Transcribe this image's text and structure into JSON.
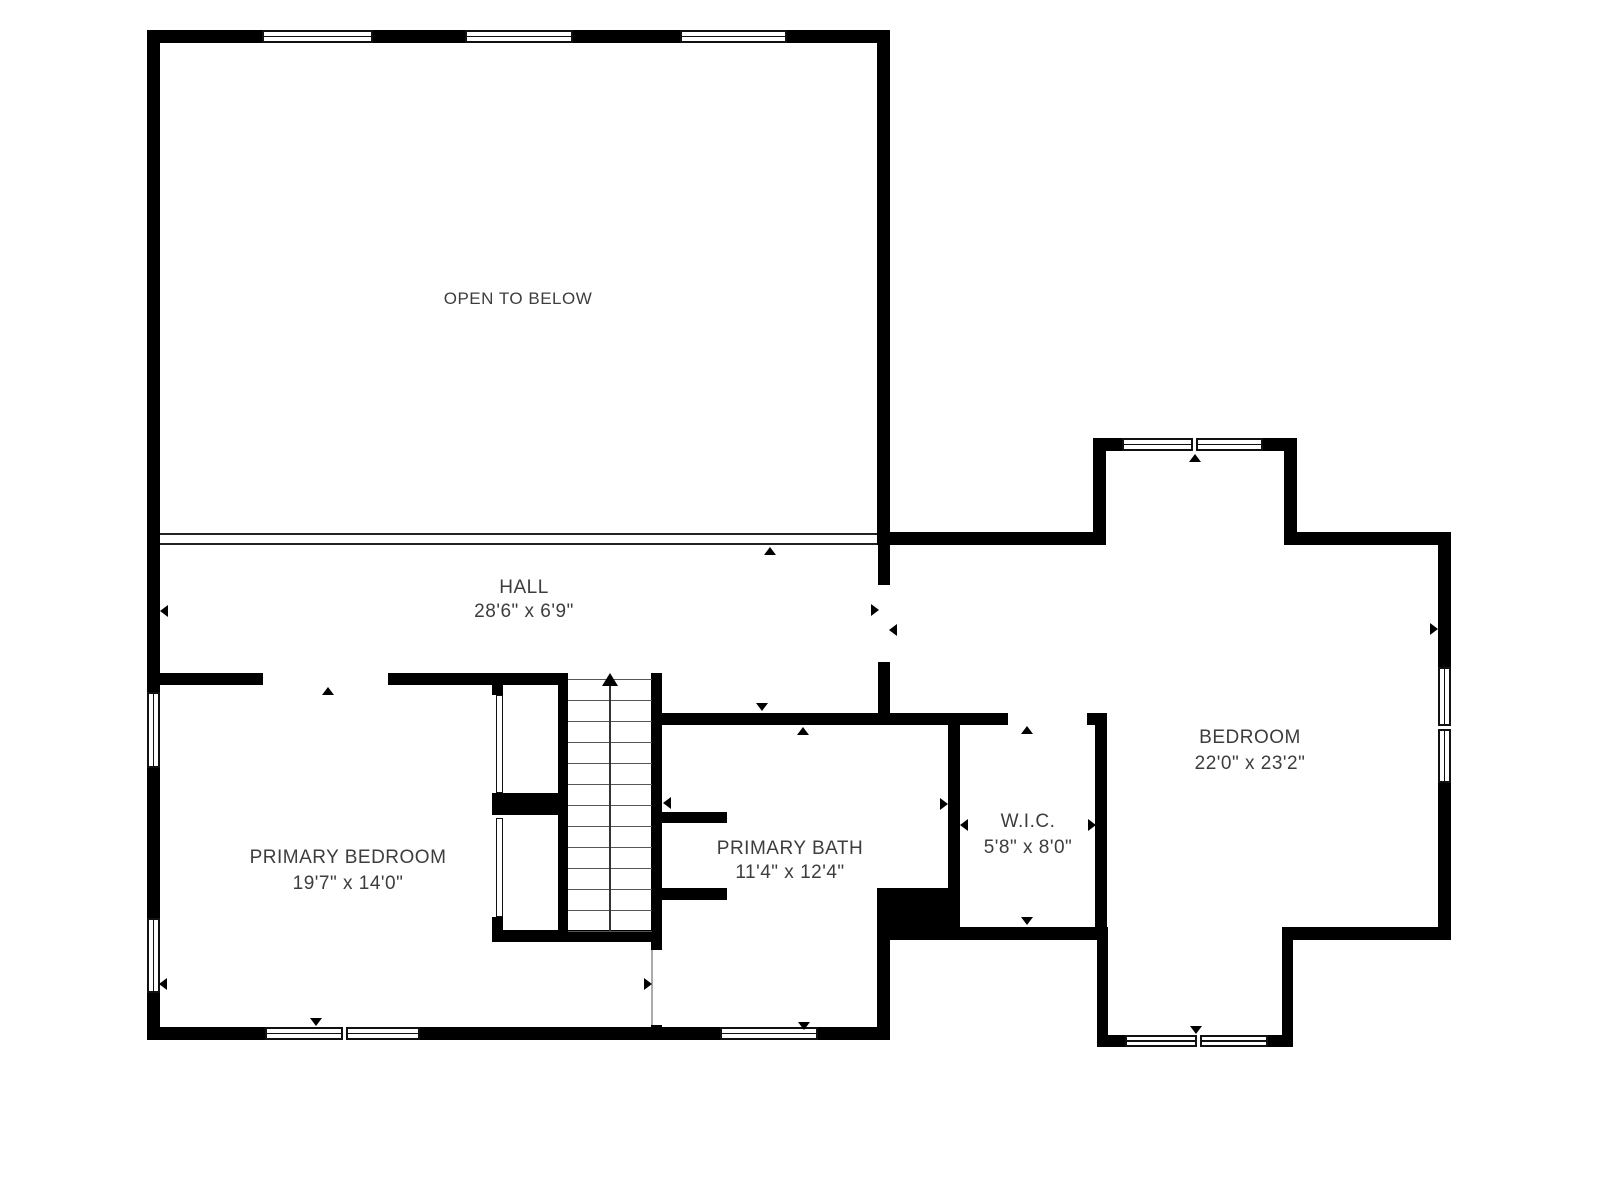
{
  "plan": {
    "canvas": {
      "width": 1600,
      "height": 1200,
      "background": "#ffffff"
    },
    "colors": {
      "wall": "#000000",
      "window_frame": "#111111",
      "railing": "#222222",
      "tread": "#555555",
      "stair_line": "#333333",
      "marker": "#000000",
      "label": "#3d3d3d",
      "door_line": "#aaaaaa"
    },
    "rooms": [
      {
        "name": "OPEN TO BELOW",
        "dims": "",
        "cx": 518,
        "cy": 299,
        "cy2": 0,
        "font": 17
      },
      {
        "name": "HALL",
        "dims": "28'6\" x 6'9\"",
        "cx": 524,
        "cy": 588,
        "cy2": 612,
        "font": 19
      },
      {
        "name": "PRIMARY BEDROOM",
        "dims": "19'7\" x 14'0\"",
        "cx": 348,
        "cy": 858,
        "cy2": 884,
        "font": 19
      },
      {
        "name": "PRIMARY BATH",
        "dims": "11'4\" x 12'4\"",
        "cx": 790,
        "cy": 849,
        "cy2": 873,
        "font": 19
      },
      {
        "name": "W.I.C.",
        "dims": "5'8\" x 8'0\"",
        "cx": 1028,
        "cy": 822,
        "cy2": 848,
        "font": 19
      },
      {
        "name": "BEDROOM",
        "dims": "22'0\" x 23'2\"",
        "cx": 1250,
        "cy": 738,
        "cy2": 764,
        "font": 19
      }
    ],
    "walls": [
      [
        147,
        30,
        743,
        13
      ],
      [
        147,
        30,
        13,
        1010
      ],
      [
        877,
        30,
        13,
        515
      ],
      [
        147,
        1027,
        743,
        13
      ],
      [
        147,
        673,
        116,
        12
      ],
      [
        388,
        673,
        180,
        12
      ],
      [
        558,
        673,
        10,
        269
      ],
      [
        651,
        673,
        11,
        277
      ],
      [
        492,
        930,
        170,
        12
      ],
      [
        492,
        685,
        11,
        10
      ],
      [
        492,
        793,
        66,
        22
      ],
      [
        492,
        917,
        11,
        25
      ],
      [
        878,
        545,
        12,
        40
      ],
      [
        878,
        662,
        12,
        51
      ],
      [
        878,
        532,
        228,
        13
      ],
      [
        1093,
        438,
        13,
        107
      ],
      [
        1093,
        438,
        204,
        13
      ],
      [
        1284,
        438,
        13,
        107
      ],
      [
        1284,
        532,
        167,
        13
      ],
      [
        1438,
        532,
        13,
        408
      ],
      [
        1284,
        927,
        167,
        13
      ],
      [
        1282,
        927,
        11,
        120
      ],
      [
        1097,
        1035,
        196,
        12
      ],
      [
        1097,
        927,
        11,
        120
      ],
      [
        890,
        927,
        218,
        13
      ],
      [
        948,
        713,
        12,
        179
      ],
      [
        877,
        888,
        83,
        42
      ],
      [
        877,
        925,
        13,
        115
      ],
      [
        652,
        713,
        356,
        12
      ],
      [
        1087,
        713,
        20,
        12
      ],
      [
        1095,
        713,
        12,
        227
      ],
      [
        662,
        812,
        65,
        11
      ],
      [
        662,
        888,
        65,
        12
      ],
      [
        651,
        930,
        11,
        20
      ],
      [
        651,
        1025,
        11,
        15
      ]
    ],
    "windows": [
      {
        "x": 262,
        "y": 30,
        "w": 111,
        "h": 13,
        "dir": "h",
        "panes": 1
      },
      {
        "x": 465,
        "y": 30,
        "w": 108,
        "h": 13,
        "dir": "h",
        "panes": 1
      },
      {
        "x": 680,
        "y": 30,
        "w": 107,
        "h": 13,
        "dir": "h",
        "panes": 1
      },
      {
        "x": 147,
        "y": 692,
        "w": 13,
        "h": 76,
        "dir": "v",
        "panes": 1
      },
      {
        "x": 147,
        "y": 918,
        "w": 13,
        "h": 75,
        "dir": "v",
        "panes": 1
      },
      {
        "x": 265,
        "y": 1027,
        "w": 155,
        "h": 13,
        "dir": "h",
        "panes": 2
      },
      {
        "x": 720,
        "y": 1027,
        "w": 98,
        "h": 13,
        "dir": "h",
        "panes": 1
      },
      {
        "x": 1122,
        "y": 438,
        "w": 141,
        "h": 13,
        "dir": "h",
        "panes": 2
      },
      {
        "x": 1438,
        "y": 667,
        "w": 13,
        "h": 116,
        "dir": "v",
        "panes": 2
      },
      {
        "x": 1125,
        "y": 1035,
        "w": 143,
        "h": 12,
        "dir": "h",
        "panes": 2
      }
    ],
    "railing": {
      "x": 160,
      "y": 533,
      "w": 717,
      "h": 12
    },
    "stairs": {
      "x": 568,
      "w": 84,
      "top": 679,
      "bottom": 931,
      "tread_count": 13,
      "tread_step": 21,
      "center_x": 610
    },
    "closet_doors": [
      {
        "x": 496,
        "y": 695,
        "w": 7,
        "h": 98
      },
      {
        "x": 496,
        "y": 818,
        "w": 7,
        "h": 99
      }
    ],
    "door_lines": [
      {
        "x": 651,
        "y": 950,
        "h": 75
      }
    ],
    "markers": [
      {
        "cx": 328,
        "cy": 691,
        "dir": "up"
      },
      {
        "cx": 164,
        "cy": 611,
        "dir": "left"
      },
      {
        "cx": 770,
        "cy": 551,
        "dir": "up"
      },
      {
        "cx": 762,
        "cy": 707,
        "dir": "down"
      },
      {
        "cx": 803,
        "cy": 731,
        "dir": "up"
      },
      {
        "cx": 667,
        "cy": 803,
        "dir": "left"
      },
      {
        "cx": 944,
        "cy": 804,
        "dir": "right"
      },
      {
        "cx": 964,
        "cy": 825,
        "dir": "left"
      },
      {
        "cx": 1092,
        "cy": 825,
        "dir": "right"
      },
      {
        "cx": 1027,
        "cy": 730,
        "dir": "up"
      },
      {
        "cx": 1027,
        "cy": 921,
        "dir": "down"
      },
      {
        "cx": 875,
        "cy": 610,
        "dir": "right"
      },
      {
        "cx": 893,
        "cy": 630,
        "dir": "left"
      },
      {
        "cx": 1195,
        "cy": 458,
        "dir": "up"
      },
      {
        "cx": 1434,
        "cy": 629,
        "dir": "right"
      },
      {
        "cx": 1196,
        "cy": 1030,
        "dir": "down"
      },
      {
        "cx": 316,
        "cy": 1022,
        "dir": "down"
      },
      {
        "cx": 804,
        "cy": 1026,
        "dir": "down"
      },
      {
        "cx": 648,
        "cy": 984,
        "dir": "right"
      },
      {
        "cx": 163,
        "cy": 984,
        "dir": "left"
      }
    ]
  }
}
